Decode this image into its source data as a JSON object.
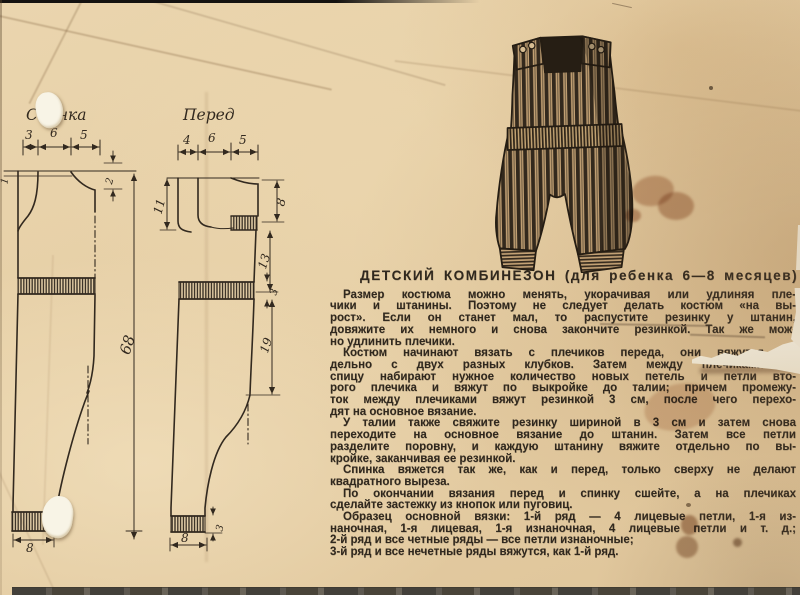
{
  "diagram": {
    "back": {
      "label": "Спинка",
      "top_widths": [
        "3",
        "6",
        "5"
      ],
      "shoulder_rise": "1",
      "neck_depth": "2",
      "total_length": "68",
      "cuff_width": "8"
    },
    "front": {
      "label": "Перед",
      "top_widths": [
        "4",
        "6",
        "5"
      ],
      "strap_depth": "11",
      "armhole_depth": "8",
      "armhole_to_waist": "13",
      "waist_rib": "3",
      "waist_to_crotch": "19",
      "cuff_rib": "3",
      "cuff_width": "8"
    }
  },
  "article": {
    "title": "ДЕТСКИЙ КОМБИНЕЗОН (для ребенка 6—8 месяцев)",
    "paragraphs": [
      {
        "lines": [
          "Размер костюма можно менять, укорачивая или удлиняя пле-",
          "чики и штанины. Поэтому не следует делать костюм «на вы-",
          "рост». Если он станет мал, то распустите резинку у штанин,",
          "довяжите их немного и снова закончите резинкой. Так же мож-",
          "но удлинить плечики."
        ]
      },
      {
        "lines": [
          "Костюм начинают вязать с плечиков переда, они вяжутся от-",
          "дельно с двух разных клубков. Затем между плечиками на",
          "спицу набирают нужное количество новых петель и петли вто-",
          "рого плечика и вяжут по выкройке до талии; причем промежу-",
          "ток между плечиками вяжут резинкой 3 см, после чего перехо-",
          "дят на основное вязание."
        ]
      },
      {
        "lines": [
          "У талии также свяжите резинку шириной в 3 см и затем снова",
          "переходите на основное вязание до штанин. Затем все петли",
          "разделите поровну, и каждую штанину вяжите отдельно по вы-",
          "кройке, заканчивая ее резинкой."
        ]
      },
      {
        "lines": [
          "Спинка вяжется так же, как и перед, только сверху не делают",
          "квадратного выреза."
        ]
      },
      {
        "lines": [
          "По окончании вязания перед и спинку сшейте, а на плечиках",
          "сделайте застежку из кнопок или пуговиц."
        ]
      },
      {
        "lines": [
          "Образец основной вязки: 1-й ряд — 4 лицевые петли, 1-я из-",
          "наночная, 1-я лицевая, 1-я изнаночная, 4 лицевые петли и т. д.;",
          "2-й ряд и все четные ряды — все петли изнаночные;",
          "3-й ряд и все нечетные ряды вяжутся, как 1-й ряд."
        ]
      }
    ]
  },
  "colors": {
    "paper": "#e7d0a7",
    "ink": "#30281e",
    "stain": "#a05a32"
  }
}
